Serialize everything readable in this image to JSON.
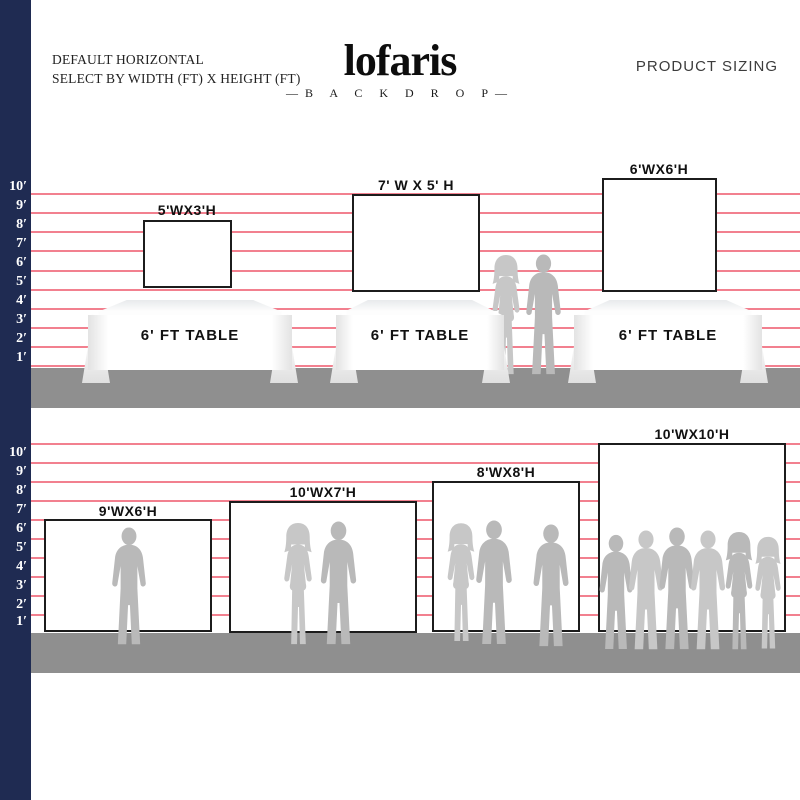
{
  "header": {
    "title_line1": "DEFAULT HORIZONTAL",
    "title_line2": "SELECT BY WIDTH (FT) X HEIGHT (FT)",
    "brand": "lofaris",
    "brand_sub": "—B A C K D R O P—",
    "right_title": "PRODUCT SIZING"
  },
  "ruler_labels": [
    "10′",
    "9′",
    "8′",
    "7′",
    "6′",
    "5′",
    "4′",
    "3′",
    "2′",
    "1′"
  ],
  "top_row": {
    "backdrops": [
      {
        "label": "5'WX3'H",
        "width_ft": 5,
        "height_ft": 3
      },
      {
        "label": "7' W X 5' H",
        "width_ft": 7,
        "height_ft": 5
      },
      {
        "label": "6'WX6'H",
        "width_ft": 6,
        "height_ft": 6
      }
    ],
    "table_label": "6' FT TABLE"
  },
  "bottom_row": {
    "backdrops": [
      {
        "label": "9'WX6'H",
        "width_ft": 9,
        "height_ft": 6
      },
      {
        "label": "10'WX7'H",
        "width_ft": 10,
        "height_ft": 7
      },
      {
        "label": "8'WX8'H",
        "width_ft": 8,
        "height_ft": 8
      },
      {
        "label": "10'WX10'H",
        "width_ft": 10,
        "height_ft": 10
      }
    ]
  },
  "colors": {
    "navy_bar": "#1f2b52",
    "grid_pink": "#f2808f",
    "ground_gray": "#8f8f8f",
    "silhouette_gray": "#b9b9b9",
    "rect_border": "#1c1c1c"
  }
}
